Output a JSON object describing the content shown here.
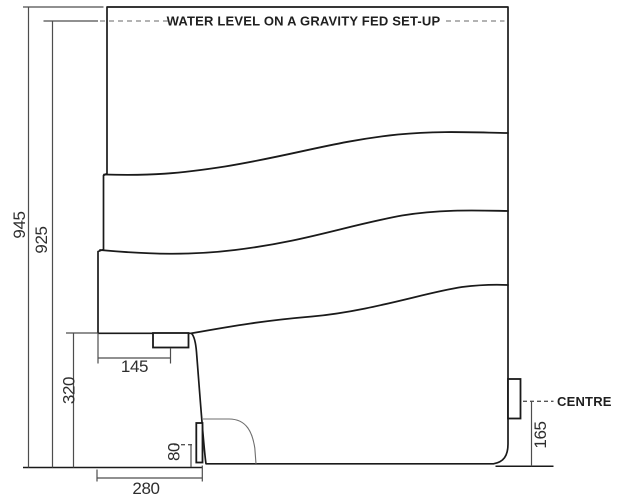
{
  "diagram": {
    "water_level_label": "WATER LEVEL ON A GRAVITY FED SET-UP",
    "centre_label": "CENTRE",
    "dimensions": {
      "overall_height": "945",
      "water_level_height": "925",
      "pan_rear_height": "320",
      "inlet_centre_from_back": "145",
      "low_level_inlet_height": "80",
      "base_depth": "280",
      "outlet_centre_height": "165"
    },
    "colors": {
      "outline": "#1a1a1a",
      "dimension_line": "#4d4d4d",
      "dash_water": "#9a9a9a",
      "dash_centre": "#555555",
      "trap_line": "#6e6e6e",
      "text": "#2e2e2e",
      "label_text": "#1f1f1f",
      "background": "#ffffff"
    }
  }
}
